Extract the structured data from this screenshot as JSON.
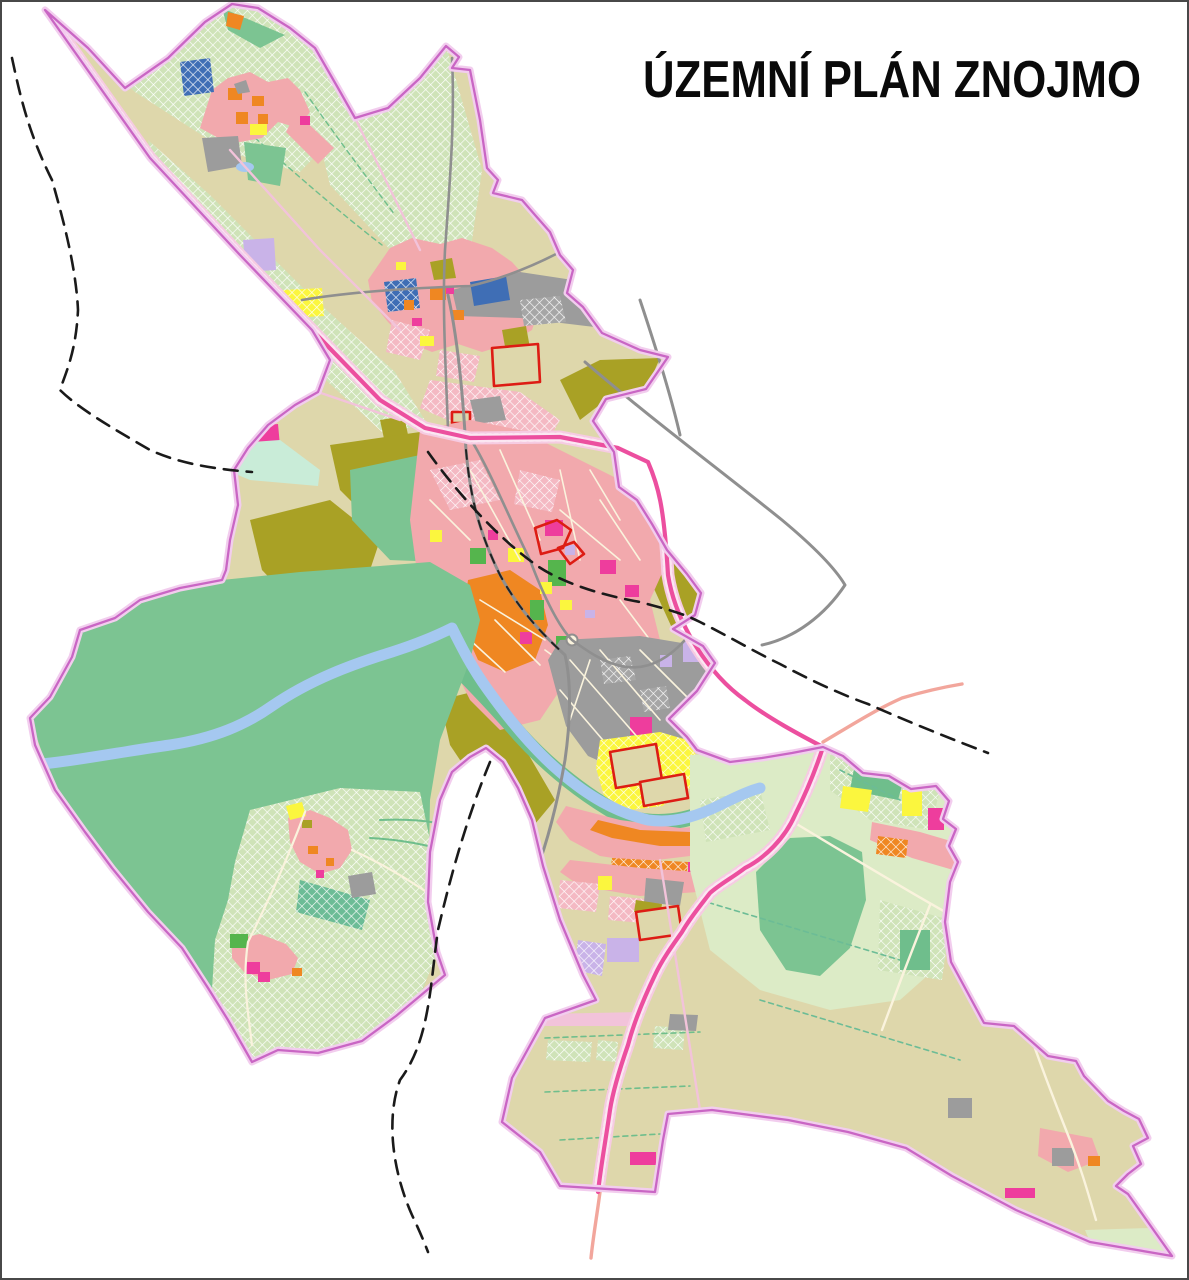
{
  "title": "ÚZEMNÍ PLÁN ZNOJMO",
  "palette": {
    "background": "#ffffff",
    "beige": "#ded7ab",
    "lightgreen": "#dcebc6",
    "hatchgreen": "#cfe3b8",
    "forest": "#7cc492",
    "midgreen": "#6fbe8c",
    "parkgreen": "#55b54d",
    "mint": "#c9ecd8",
    "olive": "#a9a125",
    "pink": "#f2a9ad",
    "rose": "#f4b9c3",
    "orange": "#ef8722",
    "magenta": "#ee3d9d",
    "yellow": "#fbf63e",
    "lavender": "#c9b3e8",
    "blue": "#3f6eb5",
    "teal": "#6cbc96",
    "water": "#a5c8f0",
    "gray": "#9c9c9c",
    "grayhatch": "#a6a6a6",
    "cream": "#faf3dd",
    "red": "#dd1c14",
    "highway": "#ec4f9f",
    "highwayband": "#f6cbe2",
    "roadgray": "#8f8f8f",
    "roadpink": "#f2c3da",
    "roadsalmon": "#f2a69c",
    "boundary": "#c966c4",
    "boundaryhalo": "#f2cdee",
    "dash": "#1a1a1a",
    "border": "#484848"
  }
}
